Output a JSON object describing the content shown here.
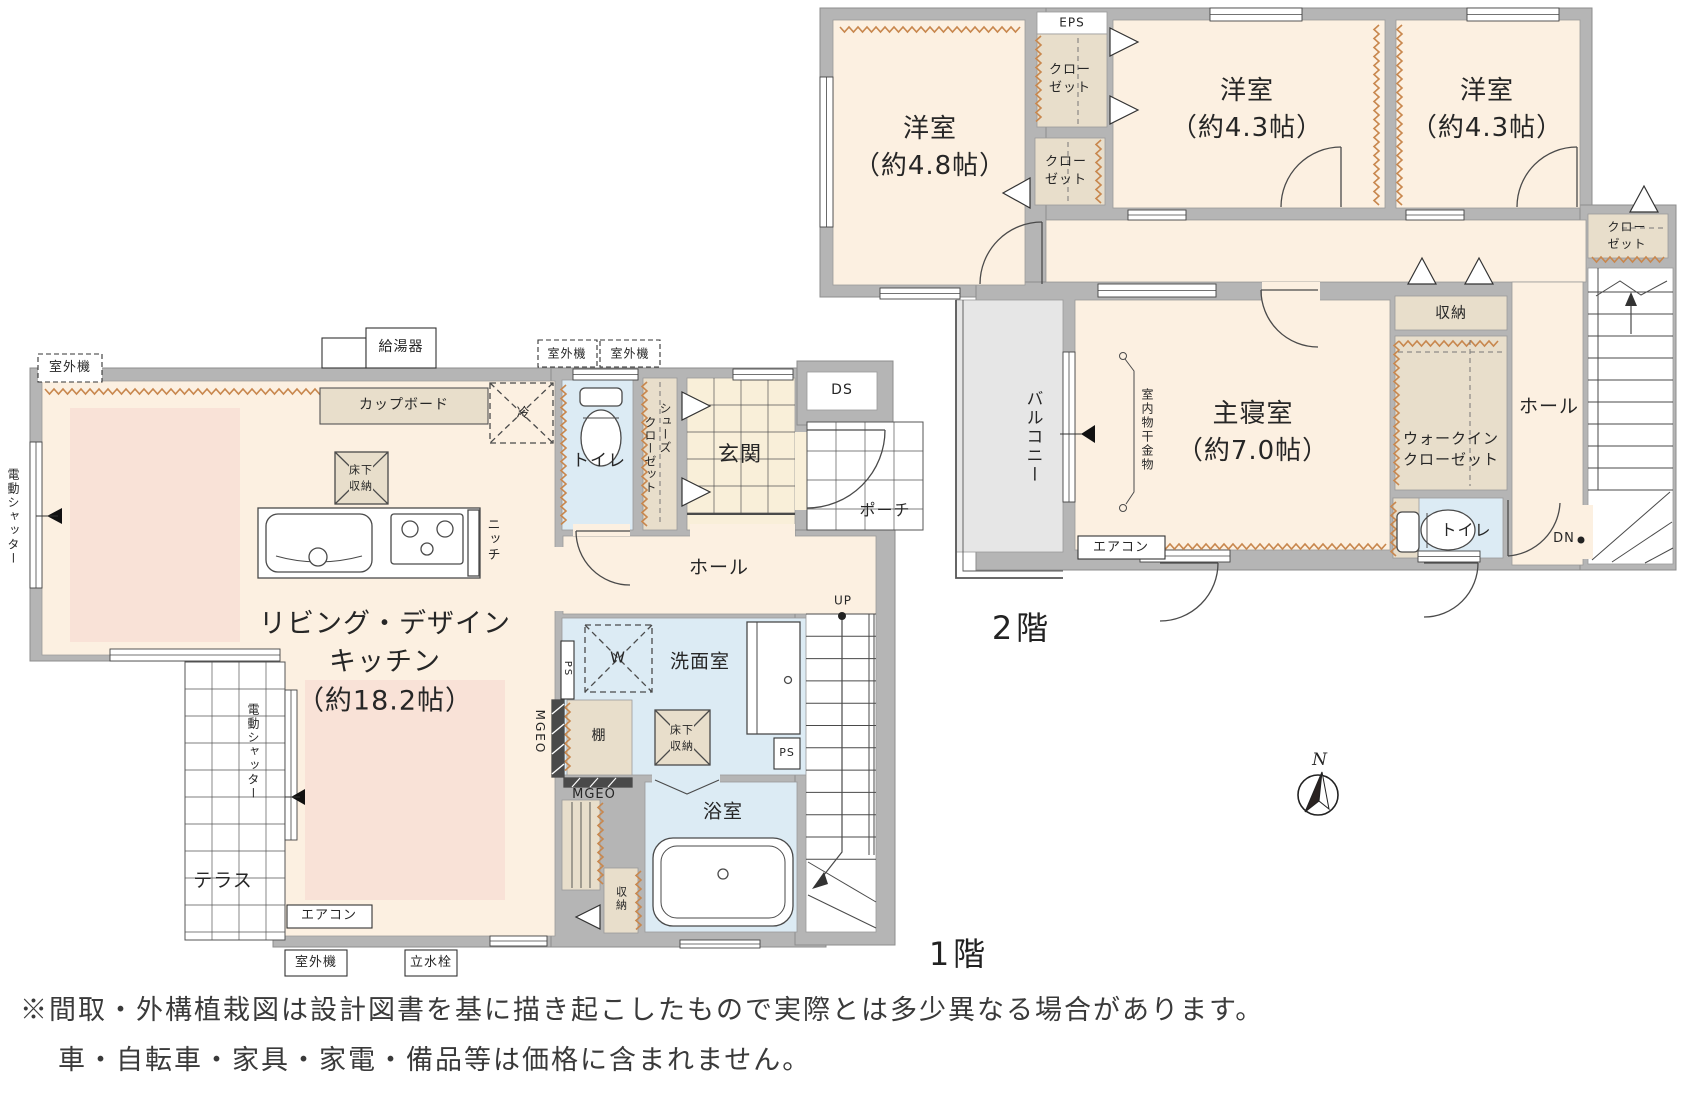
{
  "floor2": {
    "label": "2階",
    "bedroom_west": "洋室\n（約4.8帖）",
    "bedroom_center": "洋室\n（約4.3帖）",
    "bedroom_east": "洋室\n（約4.3帖）",
    "master_bedroom": "主寝室\n（約7.0帖）",
    "closet_upper": "クロー\nゼット",
    "closet_lower": "クロー\nゼット",
    "closet_east": "クロー\nゼット",
    "eps": "EPS",
    "storage": "収納",
    "walk_in_closet": "ウォークイン\nクローゼット",
    "hall": "ホール",
    "toilet": "トイレ",
    "dn": "DN",
    "balcony": "バルコニー",
    "laundry_hook": "室内物干金物",
    "aircon": "エアコン"
  },
  "floor1": {
    "label": "1階",
    "living": "リビング・デザイン\nキッチン\n（約18.2帖）",
    "outdoor_unit_top_left": "室外機",
    "water_heater": "給湯器",
    "cupboard": "カップボード",
    "fridge": "冷",
    "underfloor_storage_kitchen": "床下\n収納",
    "niche": "ニッチ",
    "outdoor_unit_mid1": "室外機",
    "outdoor_unit_mid2": "室外機",
    "toilet": "トイレ",
    "shoes_closet_col1": "クローゼット",
    "shoes_closet_col2": "シューズ",
    "entrance": "玄関",
    "ds": "DS",
    "porch": "ポーチ",
    "hall": "ホール",
    "up": "UP",
    "shutter_left": "電動シャッター",
    "shutter_terrace": "電動シャッター",
    "terrace": "テラス",
    "ps_left": "PS",
    "washer": "W",
    "washroom": "洗面室",
    "underfloor_storage_wash": "床下\n収納",
    "ps_box": "PS",
    "mgeo_side": "MGEO",
    "shelf": "棚",
    "mgeo_bottom": "MGEO",
    "bathroom": "浴室",
    "storage": "収納",
    "aircon": "エアコン",
    "outdoor_unit_bottom": "室外機",
    "faucet": "立水栓"
  },
  "compass": {
    "north": "N"
  },
  "notes": {
    "line1": "※間取・外構植栽図は設計図書を基に描き起こしたもので実際とは多少異なる場合があります。",
    "line2": "車・自転車・家具・家電・備品等は価格に含まれません。"
  },
  "colors": {
    "wall": "#b5b5b5",
    "floor": "#fcf0e1",
    "rug": "#f9e2d7",
    "closet": "#e8decb",
    "wet": "#dcebf4",
    "balcony": "#e6e6e6",
    "zigzag": "#c8874e",
    "line": "#4a4a4a"
  }
}
